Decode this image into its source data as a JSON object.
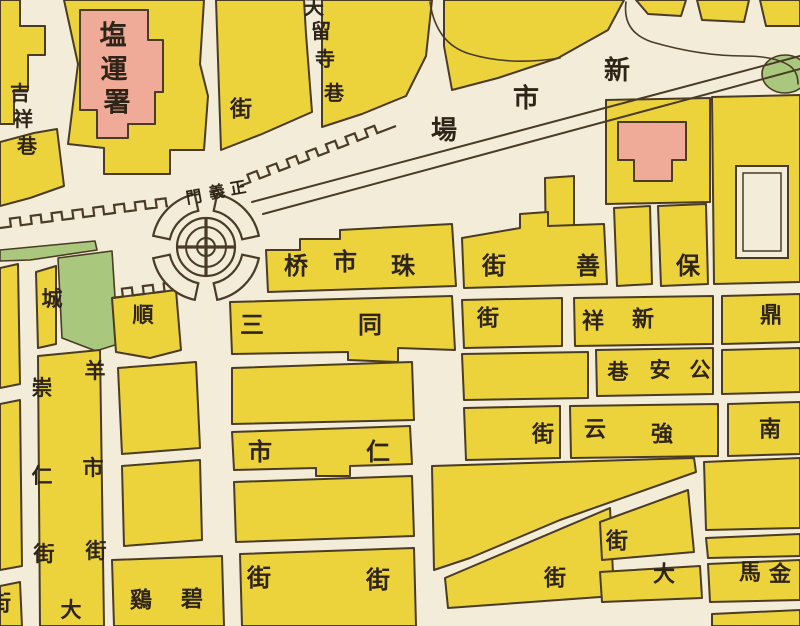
{
  "map": {
    "palette": {
      "paper": "#f2ecd8",
      "block_yellow": "#ecd33c",
      "building_pink": "#efab97",
      "park_green": "#a9c87e",
      "ink": "#4a3b24",
      "label_ink": "#2f2418"
    },
    "labels": [
      {
        "text": "塩運署",
        "direction": "vertical",
        "font_size": 27,
        "chars": [
          [
            113,
            36
          ],
          [
            114,
            70
          ],
          [
            117,
            103
          ]
        ]
      },
      {
        "text": "吉祥巷",
        "direction": "vertical",
        "font_size": 20,
        "chars": [
          [
            20,
            93
          ],
          [
            23,
            119
          ],
          [
            27,
            146
          ]
        ]
      },
      {
        "text": "街",
        "direction": "single",
        "font_size": 22,
        "chars": [
          [
            241,
            110
          ]
        ]
      },
      {
        "text": "天留寺巷",
        "direction": "vertical",
        "font_size": 20,
        "chars": [
          [
            314,
            7
          ],
          [
            321,
            31
          ],
          [
            325,
            59
          ],
          [
            334,
            93
          ]
        ]
      },
      {
        "text": "新市場",
        "direction": "horizontal",
        "font_size": 26,
        "chars": [
          [
            617,
            71
          ],
          [
            526,
            99
          ],
          [
            444,
            131
          ]
        ]
      },
      {
        "text": "正義門",
        "direction": "horizontal",
        "font_size": 16,
        "rotation": -10,
        "chars": [
          [
            238,
            188
          ],
          [
            217,
            192
          ],
          [
            194,
            197
          ]
        ]
      },
      {
        "text": "珠市桥",
        "direction": "horizontal",
        "font_size": 24,
        "chars": [
          [
            403,
            266
          ],
          [
            345,
            262
          ],
          [
            296,
            266
          ]
        ]
      },
      {
        "text": "保善街",
        "direction": "horizontal",
        "font_size": 24,
        "chars": [
          [
            688,
            266
          ],
          [
            588,
            266
          ],
          [
            494,
            266
          ]
        ]
      },
      {
        "text": "順城",
        "direction": "horizontal",
        "font_size": 21,
        "chars": [
          [
            143,
            315
          ],
          [
            52,
            299
          ]
        ]
      },
      {
        "text": "三市街",
        "direction": "vertical",
        "font_size": 24,
        "chars": [
          [
            252,
            325
          ],
          [
            260,
            452
          ],
          [
            259,
            578
          ]
        ]
      },
      {
        "text": "同仁街",
        "direction": "vertical",
        "font_size": 24,
        "chars": [
          [
            370,
            325
          ],
          [
            378,
            452
          ],
          [
            378,
            580
          ]
        ]
      },
      {
        "text": "崇仁街",
        "direction": "vertical",
        "font_size": 21,
        "chars": [
          [
            42,
            388
          ],
          [
            42,
            476
          ],
          [
            44,
            554
          ]
        ]
      },
      {
        "text": "羊市街",
        "direction": "vertical",
        "font_size": 21,
        "chars": [
          [
            95,
            371
          ],
          [
            93,
            468
          ],
          [
            96,
            551
          ]
        ]
      },
      {
        "text": "大",
        "direction": "single",
        "font_size": 21,
        "chars": [
          [
            71,
            610
          ]
        ]
      },
      {
        "text": "新祥",
        "direction": "horizontal",
        "font_size": 22,
        "chars": [
          [
            643,
            320
          ],
          [
            593,
            322
          ]
        ]
      },
      {
        "text": "鼎",
        "direction": "single",
        "font_size": 22,
        "chars": [
          [
            771,
            316
          ]
        ]
      },
      {
        "text": "街",
        "direction": "single",
        "font_size": 22,
        "chars": [
          [
            488,
            319
          ]
        ]
      },
      {
        "text": "公安巷",
        "direction": "horizontal",
        "font_size": 21,
        "chars": [
          [
            700,
            370
          ],
          [
            660,
            370
          ],
          [
            618,
            372
          ]
        ]
      },
      {
        "text": "強云",
        "direction": "horizontal",
        "font_size": 22,
        "chars": [
          [
            662,
            435
          ],
          [
            595,
            430
          ]
        ]
      },
      {
        "text": "南",
        "direction": "single",
        "font_size": 22,
        "chars": [
          [
            770,
            430
          ]
        ]
      },
      {
        "text": "街",
        "direction": "single",
        "font_size": 22,
        "chars": [
          [
            543,
            435
          ]
        ]
      },
      {
        "text": "碧鷄",
        "direction": "horizontal",
        "font_size": 22,
        "chars": [
          [
            192,
            600
          ],
          [
            141,
            601
          ]
        ]
      },
      {
        "text": "街",
        "direction": "single",
        "font_size": 22,
        "chars": [
          [
            617,
            542
          ]
        ]
      },
      {
        "text": "街",
        "direction": "single",
        "font_size": 22,
        "chars": [
          [
            555,
            579
          ]
        ]
      },
      {
        "text": "大",
        "direction": "single",
        "font_size": 22,
        "chars": [
          [
            664,
            575
          ]
        ]
      },
      {
        "text": "金馬",
        "direction": "horizontal",
        "font_size": 22,
        "chars": [
          [
            780,
            575
          ],
          [
            750,
            573
          ]
        ]
      },
      {
        "text": "街",
        "direction": "single",
        "font_size": 22,
        "chars": [
          [
            0,
            604
          ]
        ]
      }
    ]
  }
}
